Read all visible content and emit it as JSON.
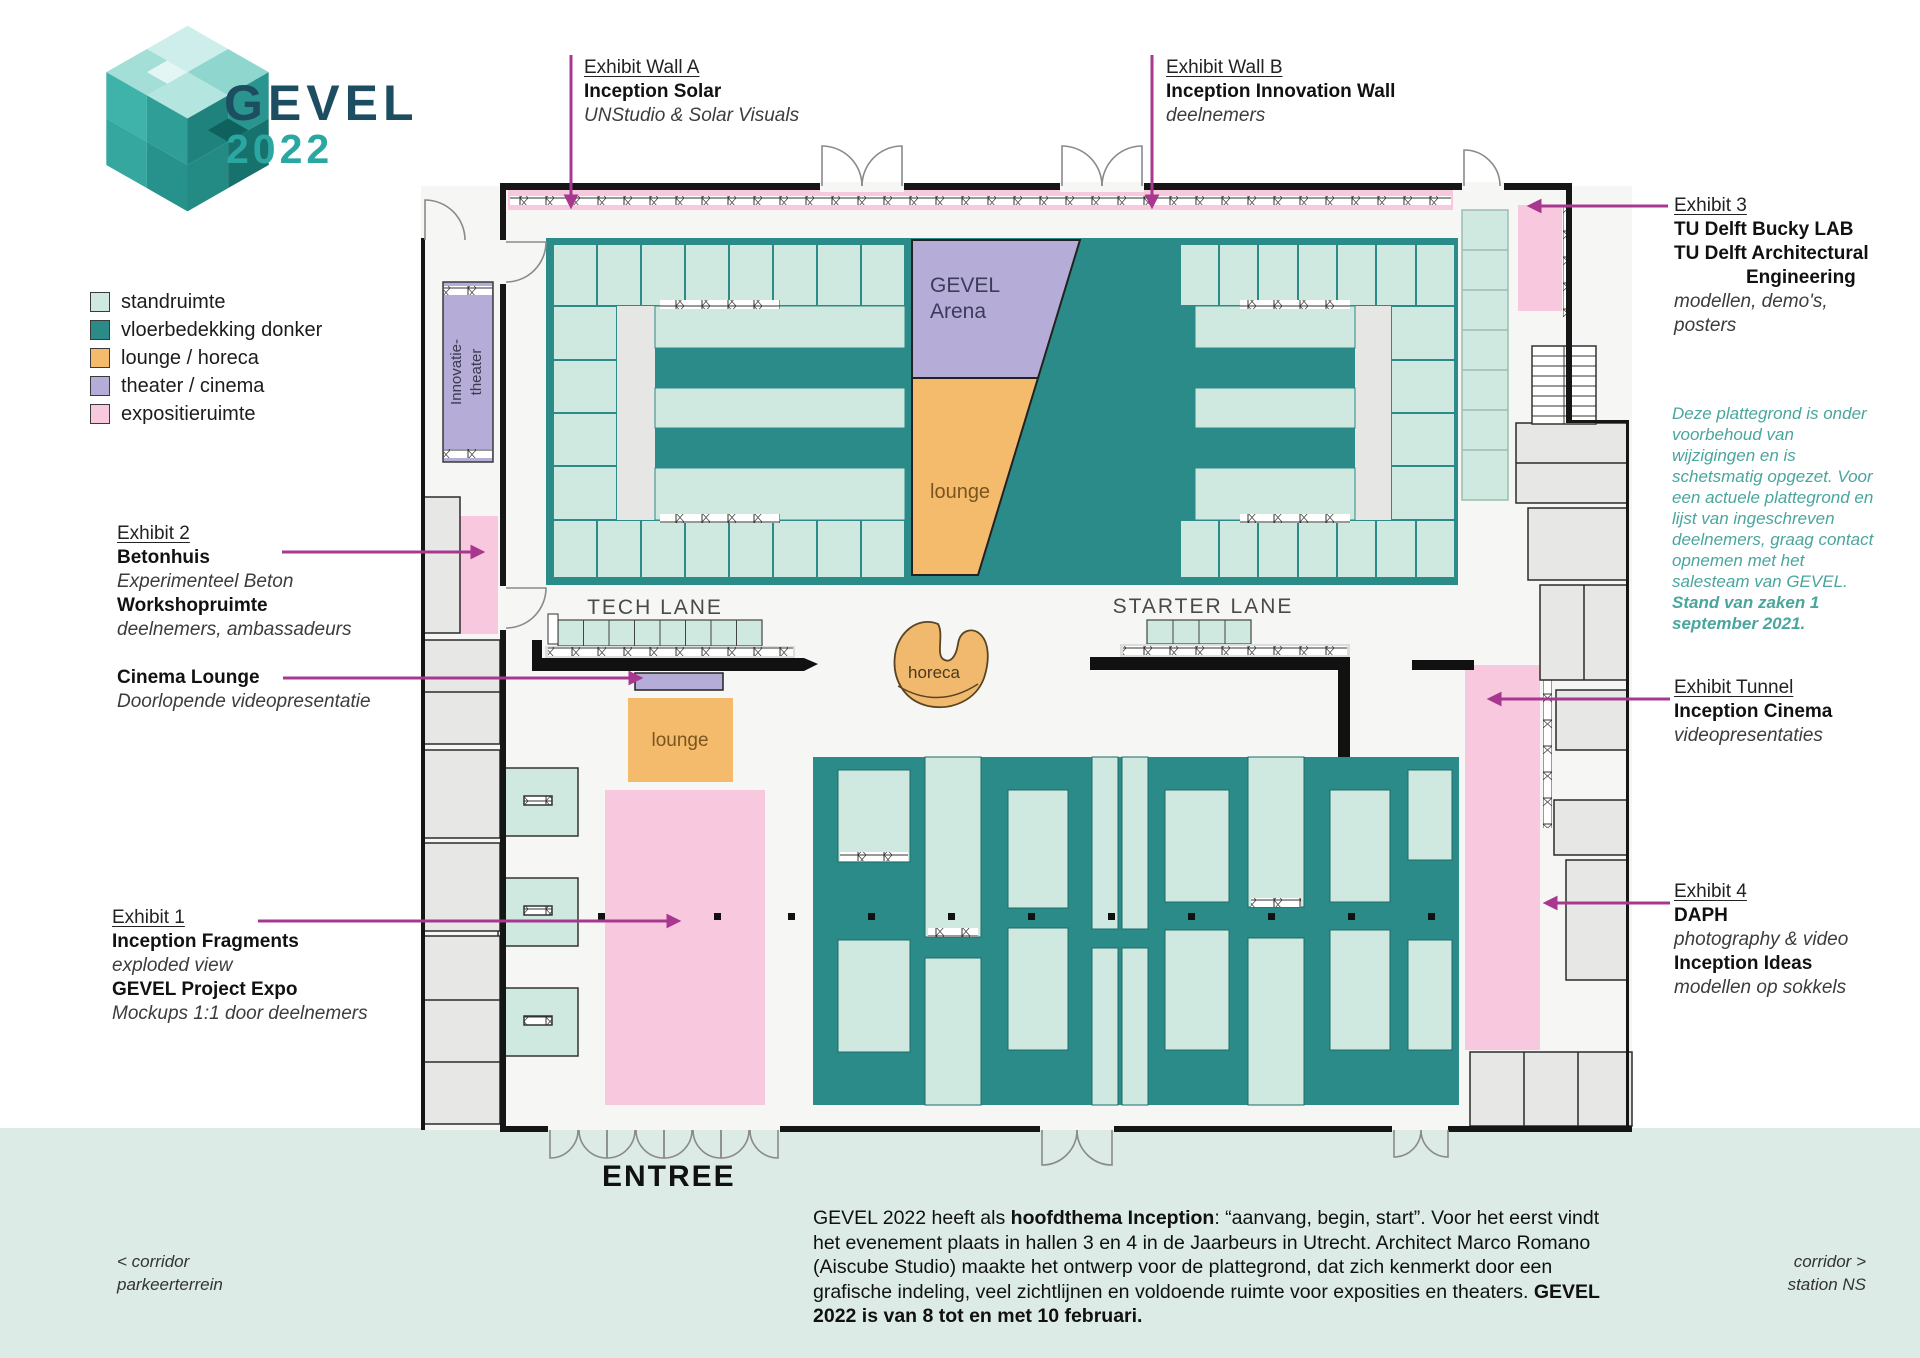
{
  "logo": {
    "name": "GEVEL",
    "year": "2022"
  },
  "legend": {
    "items": [
      {
        "label": "standruimte",
        "color": "#cfe9e1"
      },
      {
        "label": "vloerbedekking donker",
        "color": "#2b8b88"
      },
      {
        "label": "lounge / horeca",
        "color": "#f4bb6c"
      },
      {
        "label": "theater / cinema",
        "color": "#b5acd7"
      },
      {
        "label": "expositieruimte",
        "color": "#f8c8de"
      }
    ]
  },
  "callouts": {
    "wall_a": {
      "title": "Exhibit Wall A",
      "bold": "Inception Solar",
      "italic": "UNStudio & Solar Visuals"
    },
    "wall_b": {
      "title": "Exhibit Wall B",
      "bold": "Inception Innovation Wall",
      "italic": "deelnemers"
    },
    "exhibit3": {
      "title": "Exhibit 3",
      "bold1": "TU Delft Bucky LAB",
      "bold2": "TU Delft Architectural",
      "bold3": "Engineering",
      "italic": "modellen, demo's, posters"
    },
    "exhibit2": {
      "title": "Exhibit 2",
      "bold1": "Betonhuis",
      "italic1": "Experimenteel Beton",
      "bold2": "Workshopruimte",
      "italic2": "deelnemers, ambassadeurs"
    },
    "cinema_lounge": {
      "bold": "Cinema Lounge",
      "italic": "Doorlopende videopresentatie"
    },
    "exhibit1": {
      "title": "Exhibit 1",
      "bold1": "Inception Fragments",
      "italic1": "exploded view",
      "bold2": "GEVEL Project Expo",
      "italic2": "Mockups 1:1 door deelnemers"
    },
    "tunnel": {
      "title": "Exhibit Tunnel",
      "bold": "Inception Cinema",
      "italic": "videopresentaties"
    },
    "exhibit4": {
      "title": "Exhibit 4",
      "bold1": "DAPH",
      "italic1": "photography & video",
      "bold2": "Inception Ideas",
      "italic2": "modellen op sokkels"
    }
  },
  "notice": {
    "segments": [
      {
        "t": "Deze plattegrond is onder voorbehoud van wijzigingen en is schetsmatig opgezet. Voor een actuele plattegrond en lijst van ingeschreven deelnemers, graag contact opnemen met het salesteam van GEVEL. ",
        "b": false
      },
      {
        "t": "Stand van zaken 1 september 2021.",
        "b": true
      }
    ]
  },
  "plan": {
    "arena_line1": "GEVEL",
    "arena_line2": "Arena",
    "arena_lounge": "lounge",
    "tech_lane": "TECH LANE",
    "starter_lane": "STARTER LANE",
    "horeca": "horeca",
    "lounge_square": "lounge",
    "innovatie_line1": "Innovatie-",
    "innovatie_line2": "theater",
    "entree": "ENTREE"
  },
  "footer": {
    "segments": [
      {
        "t": "GEVEL 2022 heeft als ",
        "b": false
      },
      {
        "t": "hoofdthema Inception",
        "b": true
      },
      {
        "t": ": “aanvang, begin, start”. Voor het eerst vindt het evenement plaats in hallen 3 en 4 in de Jaarbeurs in Utrecht. Architect Marco Romano (Aiscube Studio) maakte het ontwerp voor de plattegrond, dat zich kenmerkt door een grafische indeling, veel zichtlijnen en voldoende ruimte voor exposities en theaters. ",
        "b": false
      },
      {
        "t": "GEVEL 2022 is van 8 tot en met 10 februari.",
        "b": true
      }
    ],
    "corridor_left_line1": "< corridor",
    "corridor_left_line2": "parkeerterrein",
    "corridor_right_line1": "corridor >",
    "corridor_right_line2": "station NS"
  },
  "colors": {
    "brand_dark": "#1d4d60",
    "brand_teal": "#2ba7a2",
    "floor_dark": "#2b8b88",
    "stand_light": "#cfe9e1",
    "lounge_orange": "#f4bb6c",
    "theater_purple": "#b5acd7",
    "expo_pink": "#f8c8de",
    "callout_magenta": "#a8388f",
    "note_teal": "#4aa59d",
    "band_mint": "#dcebe6"
  }
}
